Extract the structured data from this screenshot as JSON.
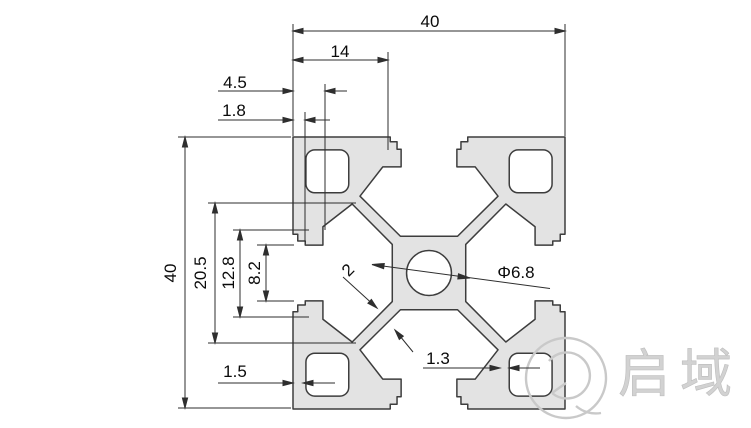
{
  "drawing": {
    "type": "technical-cross-section",
    "subject": "aluminium-extrusion-profile-4040",
    "dimensions": {
      "top_width": "40",
      "slot_position": "14",
      "lip_depth": "4.5",
      "notch_depth": "1.8",
      "side_height": "40",
      "cavity_width": "20.5",
      "notch_spacing": "12.8",
      "slot_opening": "8.2",
      "wall_thickness": "1.5",
      "lip_thickness": "1.3",
      "web_thickness": "2",
      "center_hole_diameter": "Φ6.8"
    },
    "watermark": {
      "brand_text": "启域"
    },
    "colors": {
      "background": "#ffffff",
      "profile_fill": "#e3e3e3",
      "line": "#2e2e2e",
      "dimension_text": "#0a0a0a",
      "watermark": "#c9c9c9"
    }
  }
}
